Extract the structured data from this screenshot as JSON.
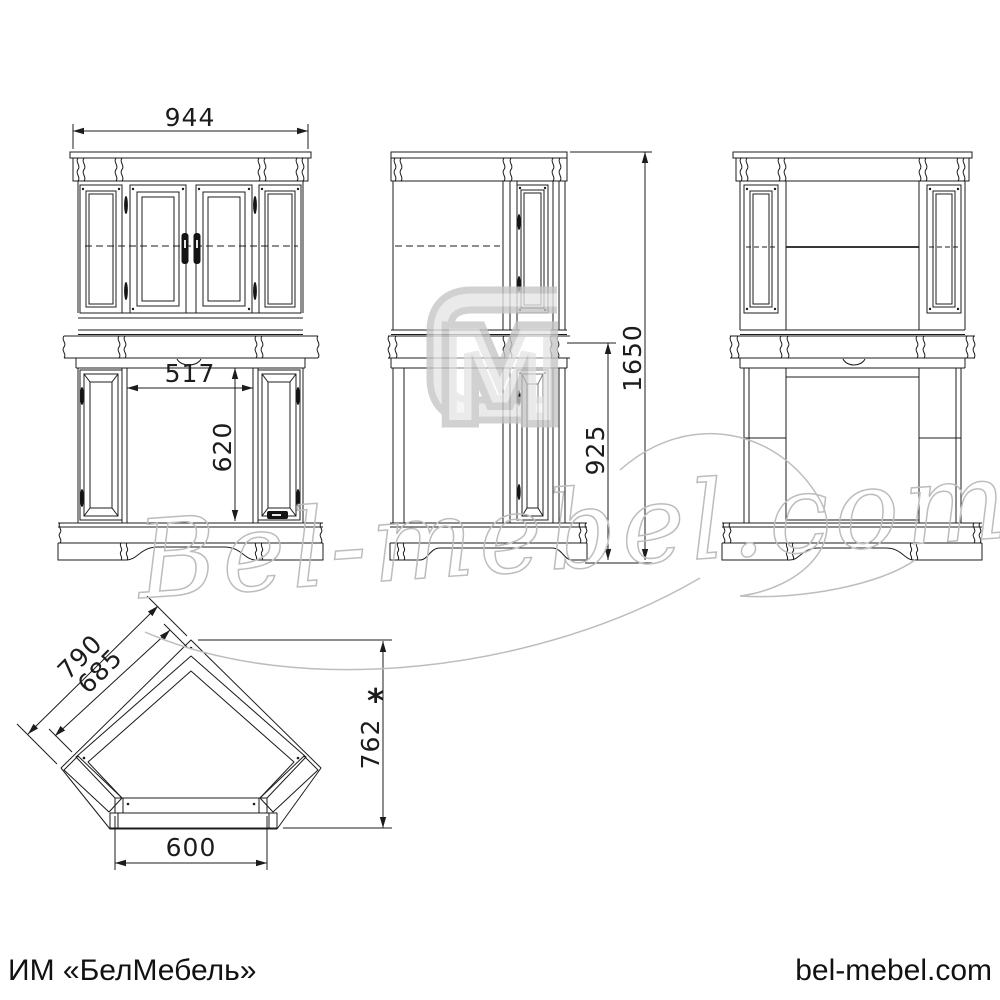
{
  "colors": {
    "line": "#1c1c1c",
    "watermark": "#bdbdbd",
    "background": "#ffffff"
  },
  "dimensions": {
    "front_width": "944",
    "opening_width": "517",
    "opening_height": "620",
    "total_height": "1650",
    "lower_height": "925",
    "plan_outer_edge": "790",
    "plan_inner_edge": "685",
    "plan_depth": "762",
    "plan_depth_note": "*",
    "plan_front_width": "600"
  },
  "watermark": {
    "script": "Bel-mebel.com",
    "logo_letter": "M"
  },
  "footer": {
    "company": "ИМ «БелМебель»",
    "website": "bel-mebel.com"
  }
}
